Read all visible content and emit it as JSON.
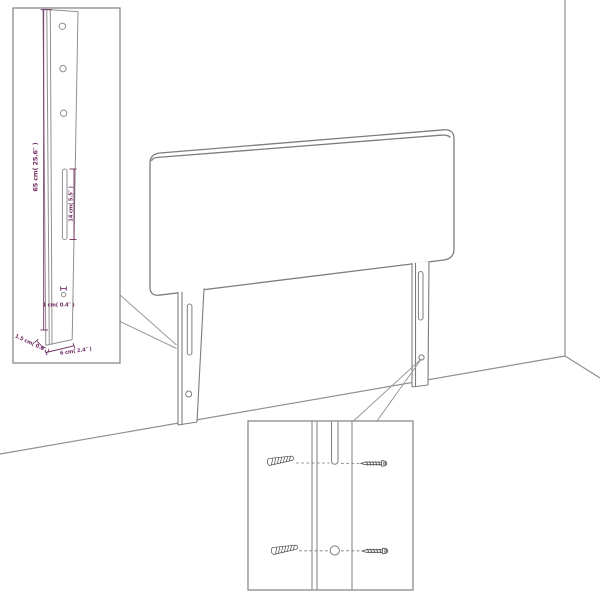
{
  "diagram": {
    "kind": "headboard-assembly-dimension-diagram",
    "colors": {
      "dimension_annotation": "#722c63",
      "outline_gray": "#7d7d7d",
      "light_gray": "#9a9a9a",
      "background": "#ffffff"
    },
    "annotations": {
      "leg_height": "65 cm( 25.6″ )",
      "slot_height": "14 cm( 5.5″ )",
      "hole_diameter": "1 cm( 0.4″ )",
      "leg_depth": "1.5 cm( 0.6″ )",
      "leg_width": "6 cm( 2.4″ )"
    }
  }
}
